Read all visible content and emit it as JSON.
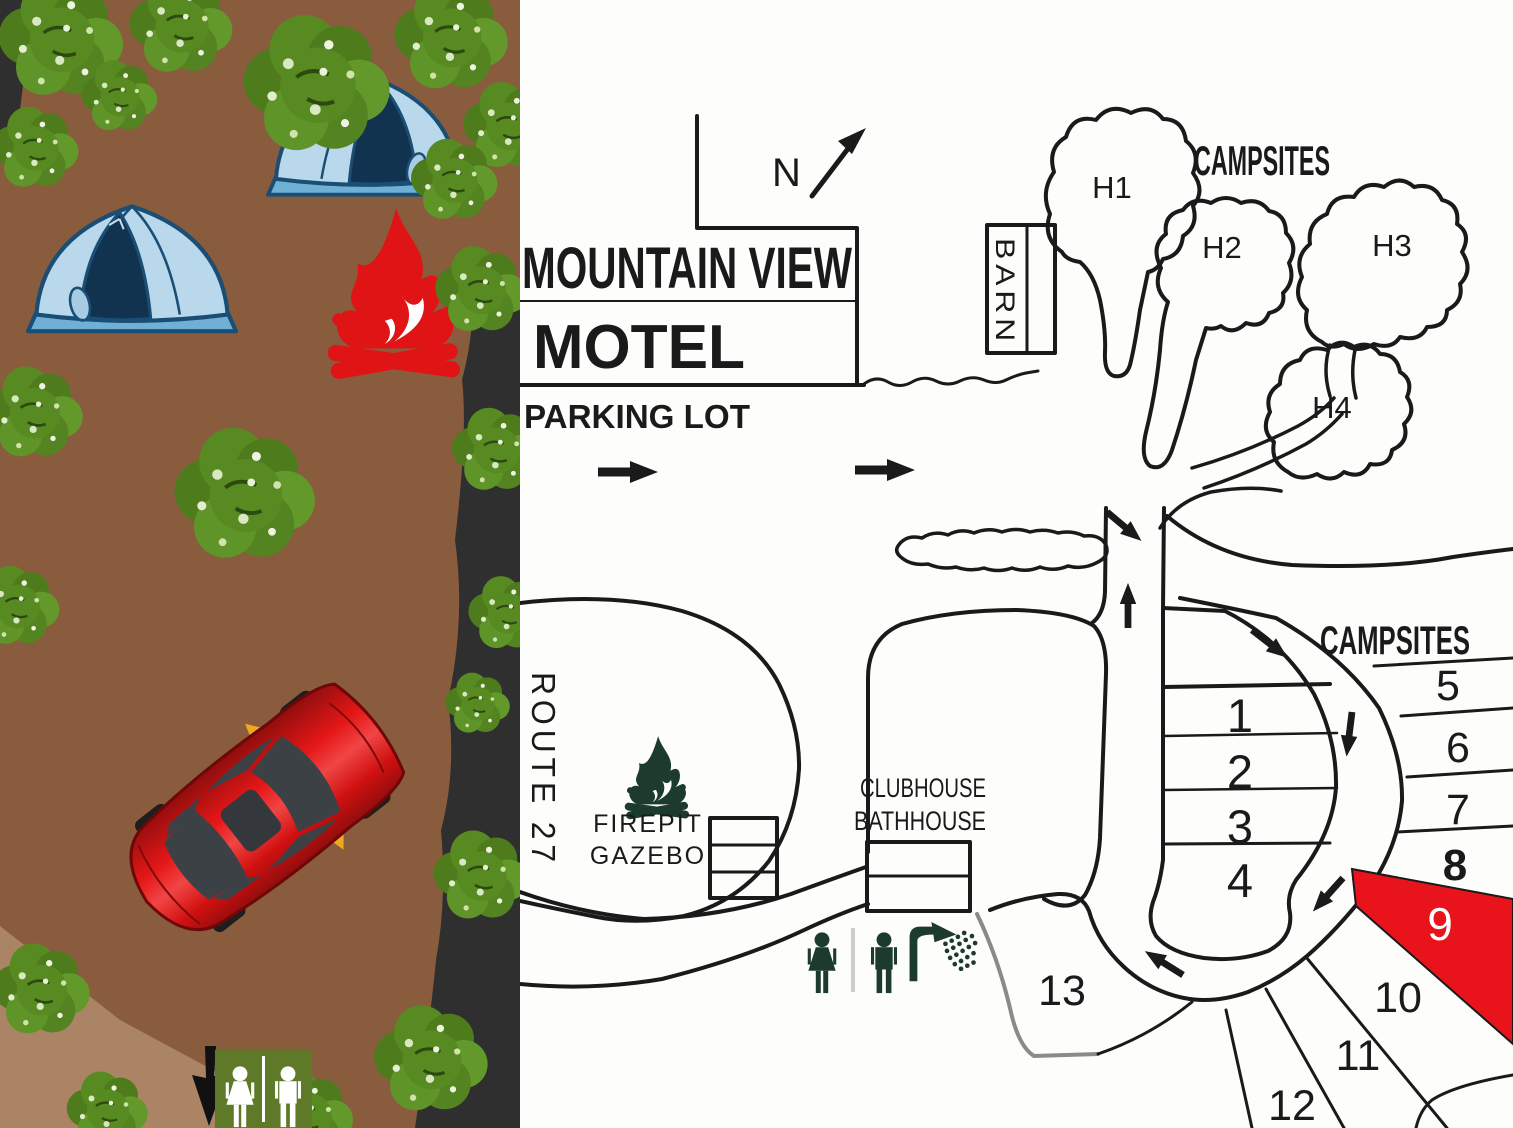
{
  "map": {
    "title": {
      "line1": "MOUNTAIN VIEW",
      "line2": "MOTEL"
    },
    "parking_label": "PARKING LOT",
    "north_label": "N",
    "barn_label": "BARN",
    "campsites_label_top": "CAMPSITES",
    "campsites_label_right": "CAMPSITES",
    "route_label": "ROUTE 27",
    "firepit": {
      "line1": "FIREPIT",
      "line2": "GAZEBO"
    },
    "clubhouse": {
      "line1": "CLUBHOUSE",
      "line2": "BATHHOUSE"
    },
    "hillside_sites": [
      {
        "label": "H1"
      },
      {
        "label": "H2"
      },
      {
        "label": "H3"
      },
      {
        "label": "H4"
      }
    ],
    "sites": [
      {
        "label": "1"
      },
      {
        "label": "2"
      },
      {
        "label": "3"
      },
      {
        "label": "4"
      },
      {
        "label": "5"
      },
      {
        "label": "6"
      },
      {
        "label": "7"
      },
      {
        "label": "8"
      },
      {
        "label": "9",
        "highlighted": true
      },
      {
        "label": "10"
      },
      {
        "label": "11"
      },
      {
        "label": "12"
      },
      {
        "label": "13"
      }
    ],
    "highlight_color": "#e8131b",
    "ink_color": "#1a1a1a",
    "gray_boundary_color": "#8a8a8a"
  },
  "colors": {
    "ground": "#8a5c3e",
    "trail": "#ab8465",
    "shadow": "#2f2f2f",
    "foliage": "#588a22",
    "foliage_dark": "#4e7c1d",
    "foliage_light": "#d8e8c0",
    "tent_light": "#b9d8ec",
    "tent_mid": "#6fb0d4",
    "tent_dark": "#12334f",
    "tent_outline": "#1b4e74",
    "fire_red": "#e01414",
    "car_red": "#cf1111",
    "mirror_yellow": "#f2a81c",
    "sign_green": "#5e7a28",
    "icon_green": "#1d3b2c",
    "map_bg": "#fdfdfb"
  },
  "icons": {
    "left_scene": [
      "tree-icon",
      "tent-icon",
      "campfire-icon",
      "car-icon",
      "down-arrow-icon",
      "restroom-sign-icon",
      "female-figure-icon",
      "male-figure-icon"
    ],
    "map": [
      "north-arrow-icon",
      "firepit-icon",
      "female-figure-icon",
      "male-figure-icon",
      "shower-icon",
      "direction-arrow-icon"
    ]
  }
}
